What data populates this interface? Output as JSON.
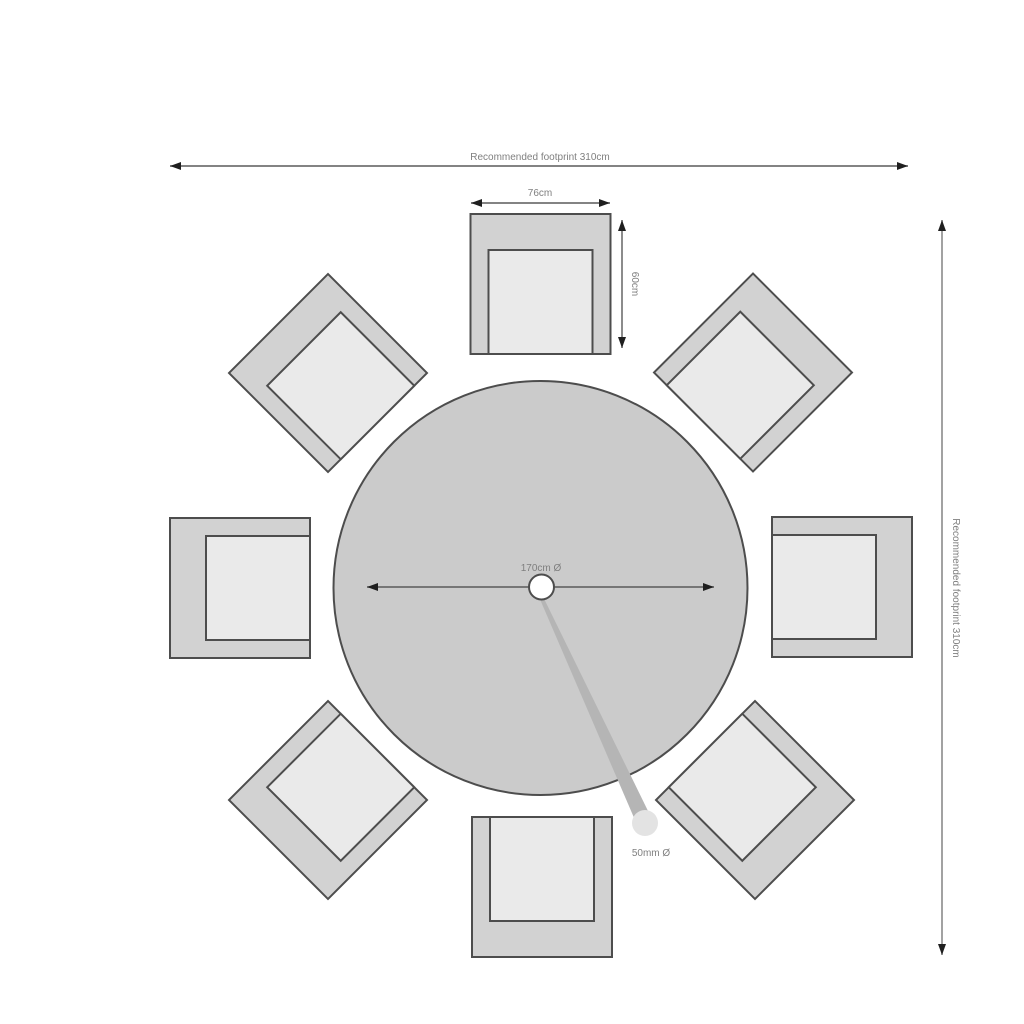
{
  "diagram": {
    "type": "furniture-footprint-plan",
    "subject": "round dining table with 8 square chairs, top view",
    "chair_count": 8,
    "dims": {
      "footprint_top": "Recommended footprint 310cm",
      "footprint_right": "Recommended footprint 310cm",
      "chair_width": "76cm",
      "chair_depth": "60cm",
      "table_diameter": "170cm Ø",
      "hole_diameter": "50mm Ø"
    },
    "colors": {
      "background": "#ffffff",
      "table_fill": "#cbcbcb",
      "chair_fill": "#d2d2d2",
      "seat_fill": "#eaeaea",
      "outline": "#4d4d4d",
      "dimension_line": "#5a5a5a",
      "label_text": "#7f7f7f",
      "callout_fill": "#b5b5b5",
      "callout_end_fill": "#e3e3e3",
      "hole_fill": "#ffffff"
    }
  }
}
